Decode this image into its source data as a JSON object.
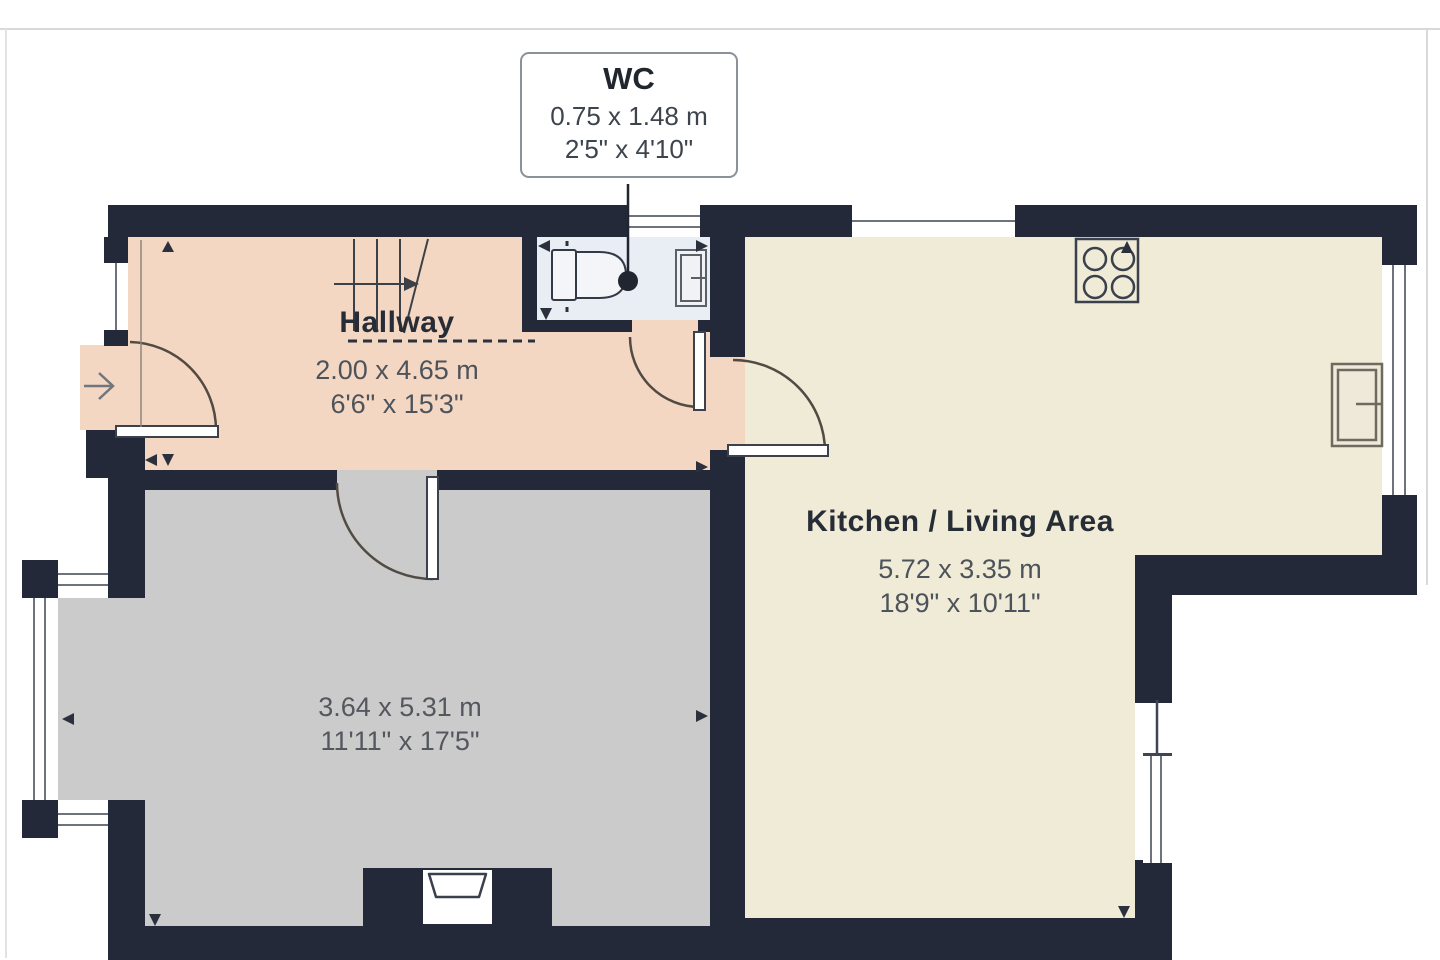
{
  "callout": {
    "room": "WC",
    "metric": "0.75 x 1.48 m",
    "imperial": "2'5\" x 4'10\""
  },
  "rooms": {
    "hallway": {
      "name": "Hallway",
      "metric": "2.00 x 4.65 m",
      "imperial": "6'6\" x 15'3\""
    },
    "kitchen": {
      "name": "Kitchen / Living Area",
      "metric": "5.72 x 3.35 m",
      "imperial": "18'9\" x 10'11\""
    },
    "reception": {
      "name": "",
      "metric": "3.64 x 5.31 m",
      "imperial": "11'11\" x 17'5\""
    }
  },
  "colors": {
    "wall": "#232938",
    "hallway_floor": "#f4d7c2",
    "wc_floor": "#e9edf4",
    "kitchen_floor": "#f0ebd7",
    "reception_floor": "#cbcbcb",
    "door_arc": "#514b44",
    "callout_border": "#8b9198",
    "label_text": "#272d36",
    "dims_text": "#4d535b"
  },
  "icons": [
    "stairs-icon",
    "toilet-icon",
    "radiator-icon",
    "hob-icon",
    "fireplace-icon",
    "entrance-arrow-icon",
    "window",
    "door-arc",
    "door-leaf",
    "dimension-arrow",
    "leader-line",
    "leader-dot"
  ]
}
